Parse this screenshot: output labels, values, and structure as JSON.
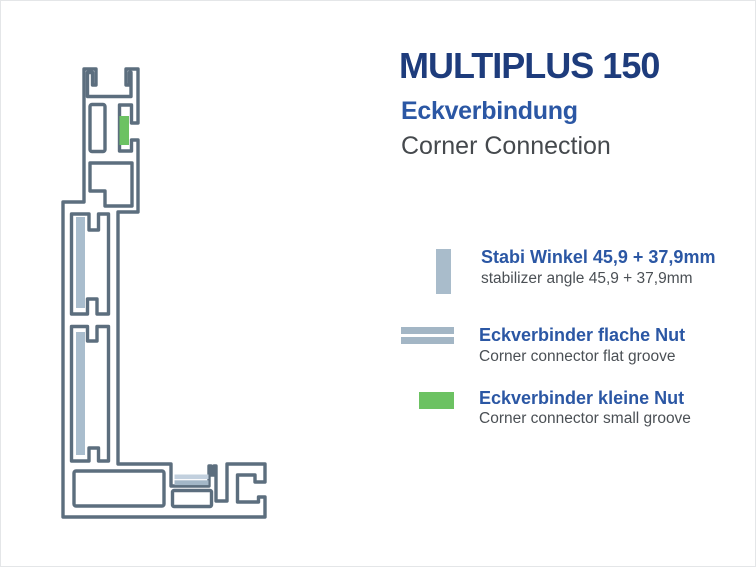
{
  "title": {
    "product": "MULTIPLUS 150",
    "subtitle_de": "Eckverbindung",
    "subtitle_en": "Corner Connection"
  },
  "legend": {
    "items": [
      {
        "id": "stabilizer-angle",
        "label_de": "Stabi Winkel 45,9 + 37,9mm",
        "label_en": "stabilizer angle 45,9 + 37,9mm",
        "swatch_shape": "vertical-bar",
        "swatch_color": "#a9bccb"
      },
      {
        "id": "corner-connector-flat-groove",
        "label_de": "Eckverbinder flache Nut",
        "label_en": "Corner connector flat groove",
        "swatch_shape": "double-horizontal-bar",
        "swatch_color": "#a3b6c5"
      },
      {
        "id": "corner-connector-small-groove",
        "label_de": "Eckverbinder kleine Nut",
        "label_en": "Corner connector small groove",
        "swatch_shape": "rectangle",
        "swatch_color": "#6cc262"
      }
    ]
  },
  "drawing": {
    "description": "L-shaped aluminium frame profile cross-section (corner connection), drawn as hollow-chamber outline with marked stabilizer angles, flat-groove corner connector and small-groove corner connector",
    "colors": {
      "outline": "#5c6e7e",
      "steel_fill": "#a9bdcd",
      "steel_fill_light": "#c2d0de",
      "green_fill": "#6cc262"
    }
  },
  "palette": {
    "title_navy": "#1e3c7c",
    "subtitle_blue": "#2b57a4",
    "subtitle_gray": "#45494d",
    "legend_blue": "#2b57a4",
    "legend_gray": "#4b5055",
    "background": "#ffffff"
  }
}
